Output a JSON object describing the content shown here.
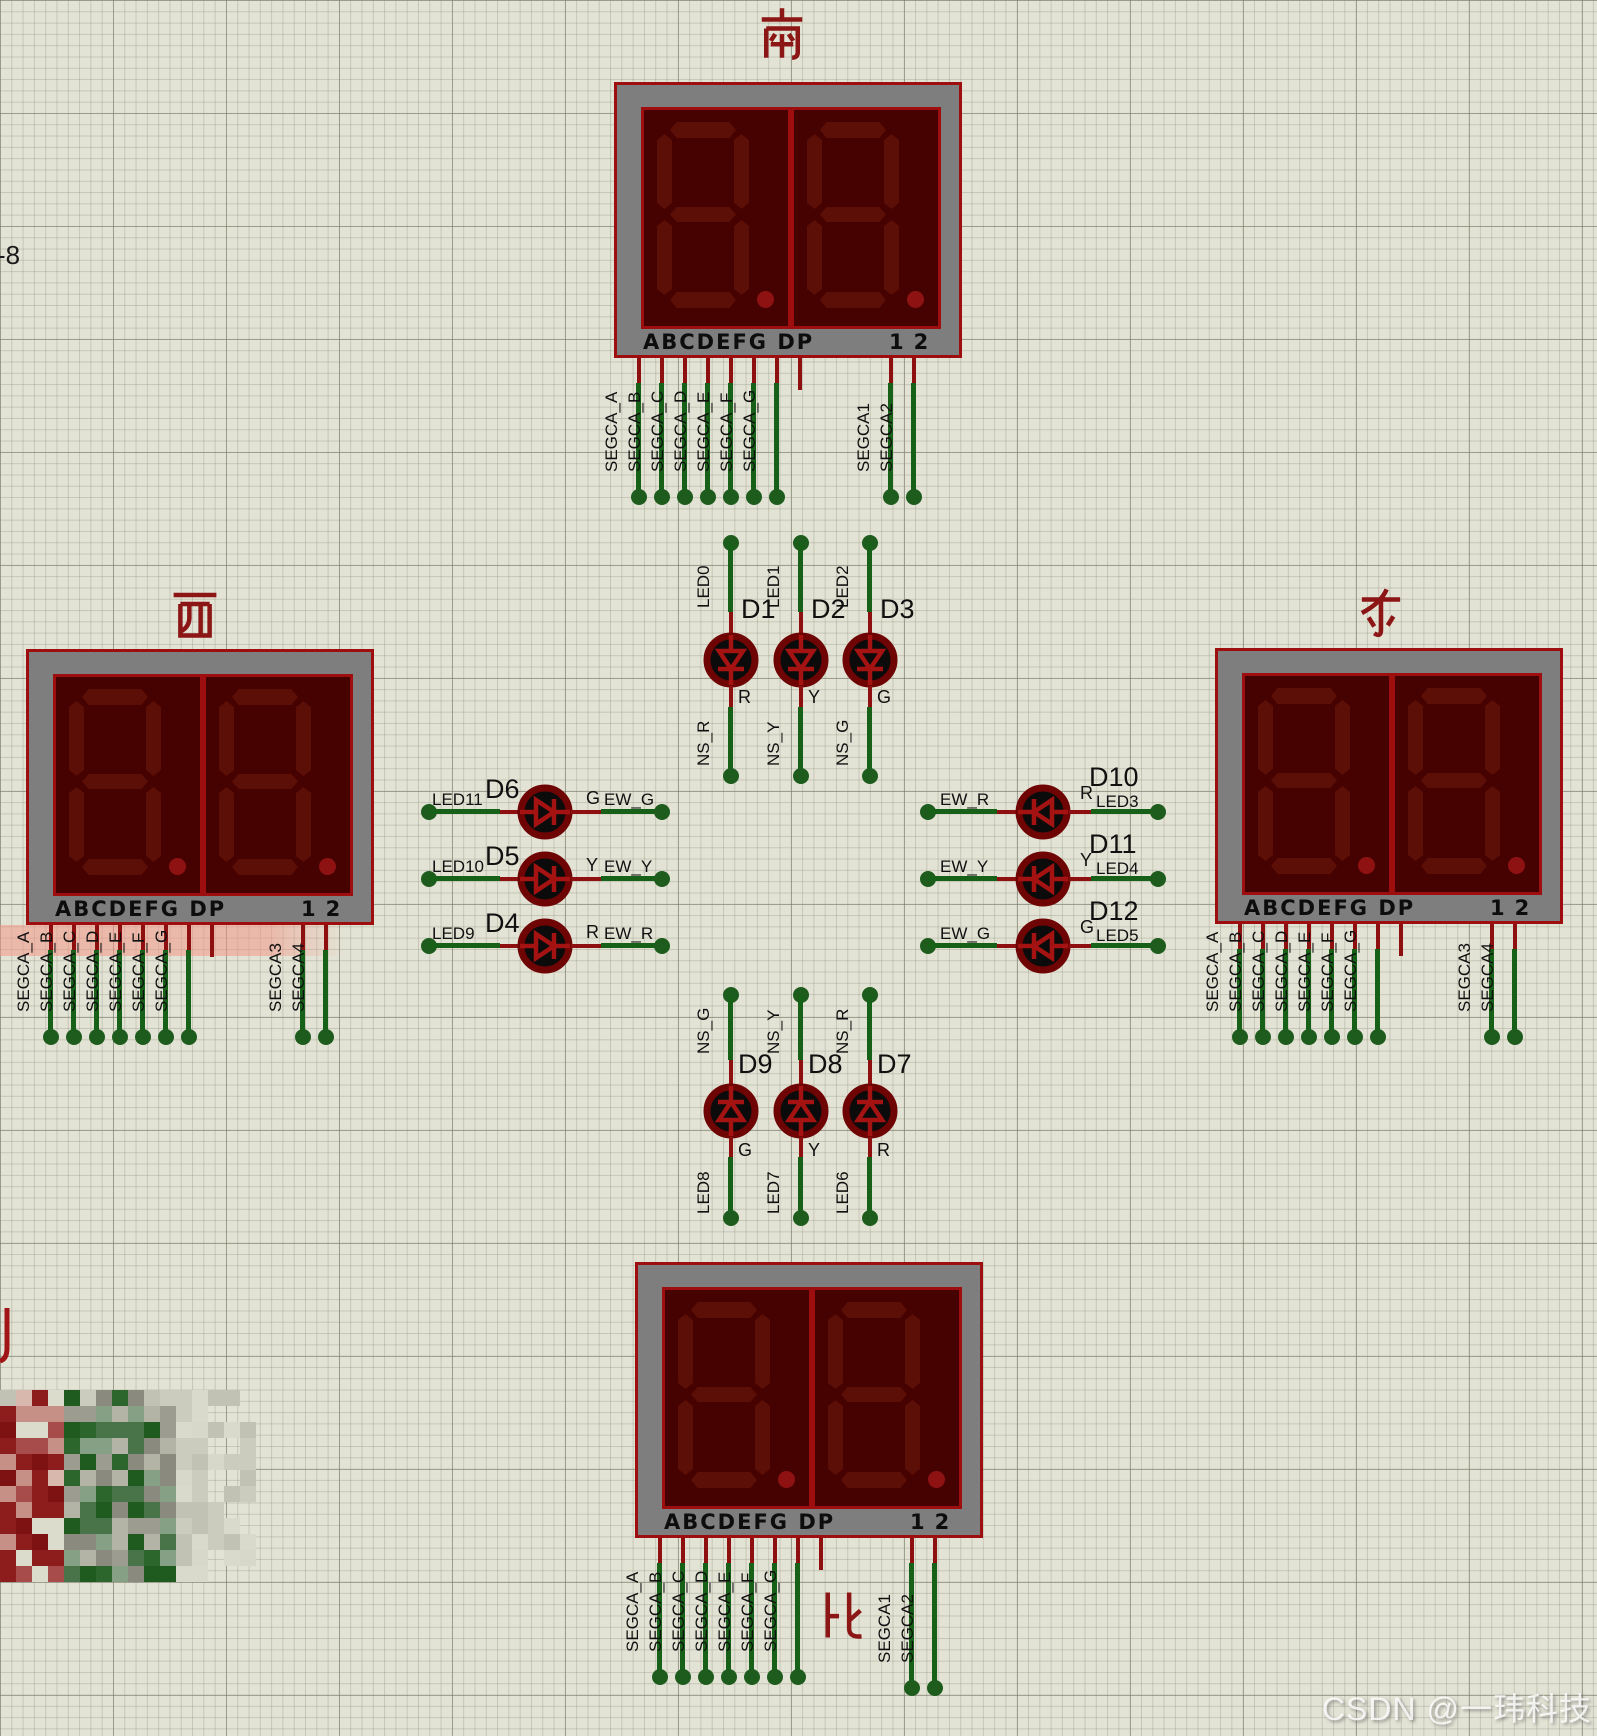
{
  "annotations": {
    "watermark": "CSDN @一玮科技",
    "stray_left_text": "-8"
  },
  "colors": {
    "grid_bg": "#e3e3d5",
    "wire_green": "#176017",
    "wire_red": "#8e0f0f",
    "display_body_gray": "#7e7e7e",
    "display_border_red": "#9e0e0e",
    "digit_panel": "#460101",
    "segment_off": "#5c0f06",
    "decimal_point": "#8e1212",
    "title_red": "#8c1515",
    "label_black": "#101010"
  },
  "displays": [
    {
      "id": "south",
      "title": "南",
      "strip_segments": "ABCDEFG DP",
      "strip_commons": "12",
      "segment_pin_labels": [
        "SEGCA_A",
        "SEGCA_B",
        "SEGCA_C",
        "SEGCA_D",
        "SEGCA_E",
        "SEGCA_F",
        "SEGCA_G"
      ],
      "common_pin_labels": [
        "SEGCA1",
        "SEGCA2"
      ]
    },
    {
      "id": "west",
      "title": "西",
      "strip_segments": "ABCDEFG DP",
      "strip_commons": "12",
      "segment_pin_labels": [
        "SEGCA_A",
        "SEGCA_B",
        "SEGCA_C",
        "SEGCA_D",
        "SEGCA_E",
        "SEGCA_F",
        "SEGCA_G"
      ],
      "common_pin_labels": [
        "SEGCA3",
        "SEGCA4"
      ]
    },
    {
      "id": "east",
      "title": "东",
      "strip_segments": "ABCDEFG DP",
      "strip_commons": "12",
      "segment_pin_labels": [
        "SEGCA_A",
        "SEGCA_B",
        "SEGCA_C",
        "SEGCA_D",
        "SEGCA_E",
        "SEGCA_F",
        "SEGCA_G"
      ],
      "common_pin_labels": [
        "SEGCA3",
        "SEGCA4"
      ]
    },
    {
      "id": "north",
      "title": "北",
      "strip_segments": "ABCDEFG DP",
      "strip_commons": "12",
      "segment_pin_labels": [
        "SEGCA_A",
        "SEGCA_B",
        "SEGCA_C",
        "SEGCA_D",
        "SEGCA_E",
        "SEGCA_F",
        "SEGCA_G"
      ],
      "common_pin_labels": [
        "SEGCA1",
        "SEGCA2"
      ]
    }
  ],
  "leds": [
    {
      "ref": "D1",
      "group": "top",
      "slot": 0,
      "anode_net": "LED0",
      "cathode_net": "NS_R",
      "color": "R"
    },
    {
      "ref": "D2",
      "group": "top",
      "slot": 1,
      "anode_net": "LED1",
      "cathode_net": "NS_Y",
      "color": "Y"
    },
    {
      "ref": "D3",
      "group": "top",
      "slot": 2,
      "anode_net": "LED2",
      "cathode_net": "NS_G",
      "color": "G"
    },
    {
      "ref": "D4",
      "group": "left",
      "slot": 2,
      "anode_net": "LED9",
      "cathode_net": "EW_R",
      "color": "R"
    },
    {
      "ref": "D5",
      "group": "left",
      "slot": 1,
      "anode_net": "LED10",
      "cathode_net": "EW_Y",
      "color": "Y"
    },
    {
      "ref": "D6",
      "group": "left",
      "slot": 0,
      "anode_net": "LED11",
      "cathode_net": "EW_G",
      "color": "G"
    },
    {
      "ref": "D7",
      "group": "bottom",
      "slot": 2,
      "anode_net": "LED6",
      "cathode_net": "NS_R",
      "color": "R"
    },
    {
      "ref": "D8",
      "group": "bottom",
      "slot": 1,
      "anode_net": "LED7",
      "cathode_net": "NS_Y",
      "color": "Y"
    },
    {
      "ref": "D9",
      "group": "bottom",
      "slot": 0,
      "anode_net": "LED8",
      "cathode_net": "NS_G",
      "color": "G"
    },
    {
      "ref": "D10",
      "group": "right",
      "slot": 0,
      "anode_net": "LED3",
      "cathode_net": "EW_R",
      "color": "R"
    },
    {
      "ref": "D11",
      "group": "right",
      "slot": 1,
      "anode_net": "LED4",
      "cathode_net": "EW_Y",
      "color": "Y"
    },
    {
      "ref": "D12",
      "group": "right",
      "slot": 2,
      "anode_net": "LED5",
      "cathode_net": "EW_G",
      "color": "G"
    }
  ]
}
